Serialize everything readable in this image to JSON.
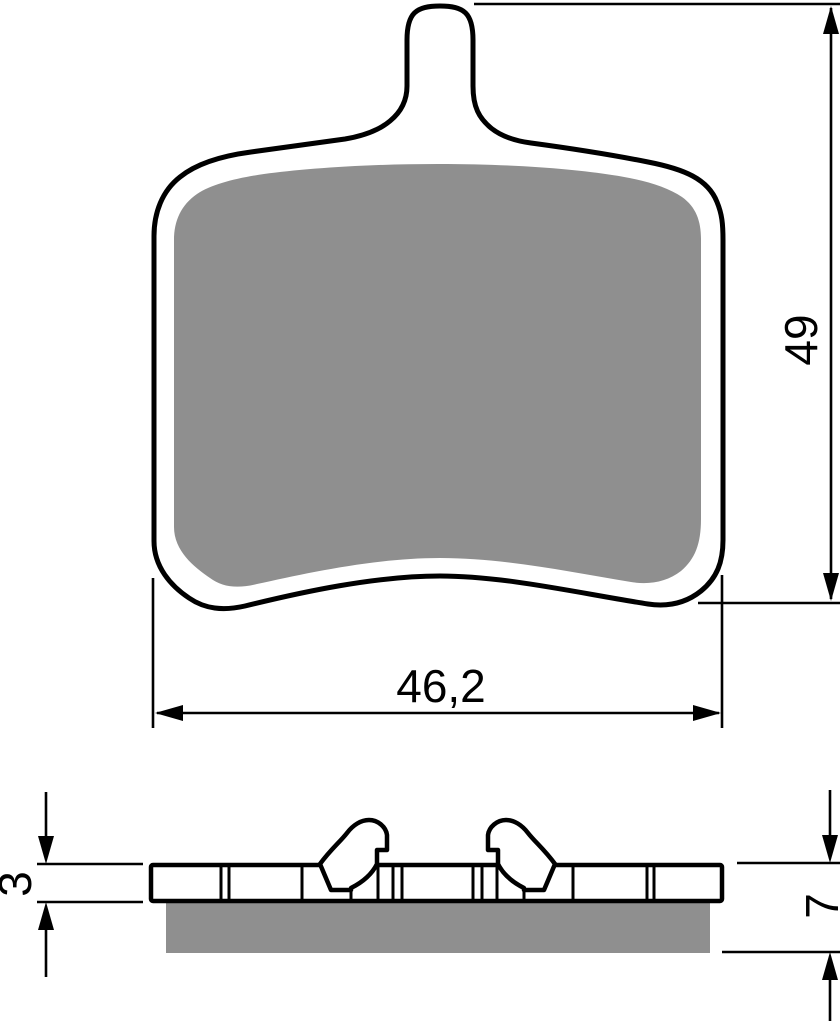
{
  "title": "Brake pad technical drawing",
  "views": {
    "front": {
      "name": "front-view"
    },
    "side": {
      "name": "side-profile-view"
    }
  },
  "dimensions": {
    "pad_height": {
      "label": "49"
    },
    "pad_width": {
      "label": "46,2"
    },
    "plate_thickness": {
      "label": "3"
    },
    "total_thickness": {
      "label": "7"
    }
  },
  "colors": {
    "friction_material": "#8f8f8f",
    "line": "#000000",
    "background": "#ffffff"
  }
}
